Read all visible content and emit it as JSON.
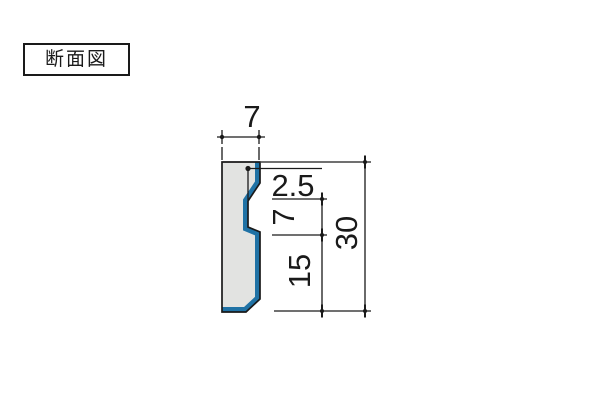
{
  "page": {
    "background": "#ffffff"
  },
  "label_box": {
    "text": "断面図"
  },
  "diagram": {
    "type": "cross-section-profile",
    "colors": {
      "profile_fill": "#e2e3e1",
      "accent_edge": "#1f72a5",
      "line": "#1a1a1a"
    },
    "dimensions": {
      "top_width": "7",
      "notch_depth": "2.5",
      "mid_segment": "7",
      "lower_segment": "15",
      "total_height": "30"
    }
  }
}
